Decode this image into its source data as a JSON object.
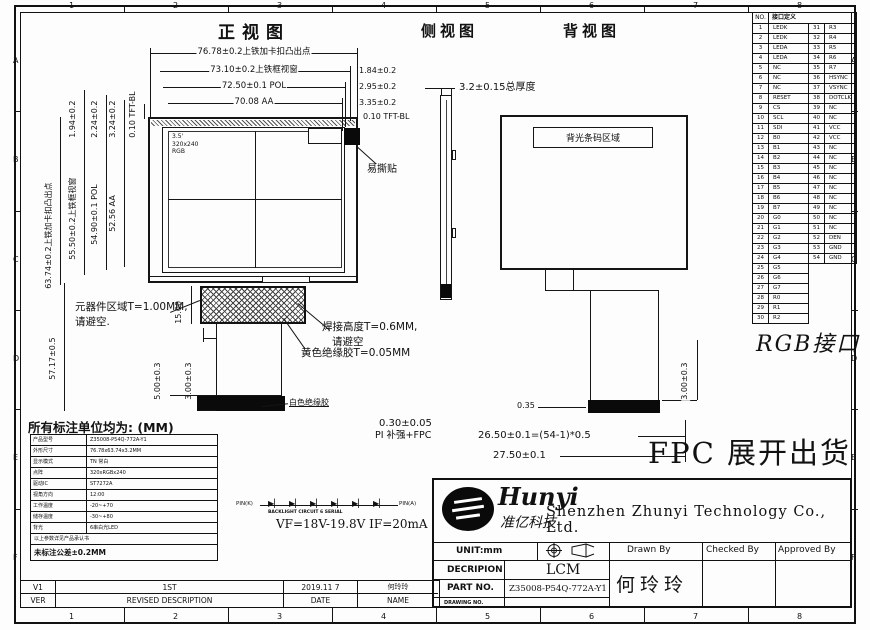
{
  "drawing": {
    "views": {
      "front_title": "正视图",
      "side_title": "侧视图",
      "back_title": "背视图"
    },
    "screen_marking": {
      "line1": "3.5'",
      "line2": "320x240",
      "line3": "RGB"
    },
    "labels": {
      "tear_sticker": "易撕贴",
      "thickness": "3.2±0.15总厚度",
      "barcode_area": "背光条码区域",
      "component_area_1": "元器件区域T=1.00MM,",
      "component_area_2": "请避空.",
      "solder_1": "焊接高度T=0.6MM,",
      "solder_2": "请避空",
      "yellow_glue": "黄色绝缘胶T=0.05MM",
      "white_glue": "白色绝缘胶",
      "pi_thickness": "0.30±0.05",
      "pi_stiffener": "PI 补强+FPC",
      "fpc_ship": "FPC 展开出货",
      "rgb_interface": "RGB接口"
    },
    "dims": {
      "top": [
        "76.78±0.2上铁加卡扣凸出点",
        "73.10±0.2上铁框视窗",
        "72.50±0.1 POL",
        "70.08 AA"
      ],
      "top_right": [
        "1.84±0.2",
        "2.95±0.2",
        "3.35±0.2",
        "0.10 TFT-BL"
      ],
      "left_small": [
        "1.94±0.2",
        "2.24±0.2",
        "3.24±0.2",
        "0.10 TFT-BL"
      ],
      "left_main": [
        "63.74±0.2上铁加卡扣凸出点",
        "55.50±0.2上铁框视窗",
        "54.90±0.1 POL",
        "52.56 AA"
      ],
      "fpc_height": "15.00",
      "fpc_width": "40.00",
      "total_left": "57.17±0.5",
      "tail_5": "5.00±0.3",
      "tail_3": "3.00±0.3",
      "back_035": "0.35",
      "back_2650": "26.50±0.1=(54-1)*0.5",
      "back_2750": "27.50±0.1",
      "back_300": "3.00±0.3"
    },
    "backlight_circuit": {
      "left_pin": "PIN(K)",
      "right_pin": "PIN(A)",
      "caption": "BACKLIGHT CIRCUIT 6 SERIAL",
      "spec": "VF=18V-19.8V   IF=20mA"
    }
  },
  "pin_table": {
    "no_header": "NO.",
    "def_header": "接口定义",
    "rows": [
      [
        1,
        "LEDK",
        31,
        "R3"
      ],
      [
        2,
        "LEDK",
        32,
        "R4"
      ],
      [
        3,
        "LEDA",
        33,
        "R5"
      ],
      [
        4,
        "LEDA",
        34,
        "R6"
      ],
      [
        5,
        "NC",
        35,
        "R7"
      ],
      [
        6,
        "NC",
        36,
        "HSYNC"
      ],
      [
        7,
        "NC",
        37,
        "VSYNC"
      ],
      [
        8,
        "RESET",
        38,
        "DOTCLK"
      ],
      [
        9,
        "CS",
        39,
        "NC"
      ],
      [
        10,
        "SCL",
        40,
        "NC"
      ],
      [
        11,
        "SDI",
        41,
        "VCC"
      ],
      [
        12,
        "B0",
        42,
        "VCC"
      ],
      [
        13,
        "B1",
        43,
        "NC"
      ],
      [
        14,
        "B2",
        44,
        "NC"
      ],
      [
        15,
        "B3",
        45,
        "NC"
      ],
      [
        16,
        "B4",
        46,
        "NC"
      ],
      [
        17,
        "B5",
        47,
        "NC"
      ],
      [
        18,
        "B6",
        48,
        "NC"
      ],
      [
        19,
        "B7",
        49,
        "NC"
      ],
      [
        20,
        "G0",
        50,
        "NC"
      ],
      [
        21,
        "G1",
        51,
        "NC"
      ],
      [
        22,
        "G2",
        52,
        "DEN"
      ],
      [
        23,
        "G3",
        53,
        "GND"
      ],
      [
        24,
        "G4",
        54,
        "GND"
      ],
      [
        25,
        "G5",
        null,
        null
      ],
      [
        26,
        "G6",
        null,
        null
      ],
      [
        27,
        "G7",
        null,
        null
      ],
      [
        28,
        "R0",
        null,
        null
      ],
      [
        29,
        "R1",
        null,
        null
      ],
      [
        30,
        "R2",
        null,
        null
      ]
    ]
  },
  "units_table": {
    "title": "所有标注单位均为: (MM)",
    "rows": [
      {
        "l": "产品型号",
        "v": "Z35008-P54Q-772A-Y1"
      },
      {
        "l": "外形尺寸",
        "v": "76.78x63.74x3.2MM"
      },
      {
        "l": "显示模式",
        "v": "TN 常白"
      },
      {
        "l": "点阵",
        "v": "320xRGBx240"
      },
      {
        "l": "驱动IC",
        "v": "ST7272A"
      },
      {
        "l": "视角方向",
        "v": "12:00"
      },
      {
        "l": "工作温度",
        "v": "-20~+70"
      },
      {
        "l": "储存温度",
        "v": "-30~+80"
      },
      {
        "l": "背光",
        "v": "6串白光LED"
      },
      {
        "l": "",
        "v": "以上参数详见产品承认书"
      },
      {
        "l": "",
        "v": "未标注公差±0.2MM"
      }
    ]
  },
  "title_block": {
    "logo_en": "Hunyi",
    "logo_cn": "准亿科技",
    "company": "Shenzhen Zhunyi Technology Co., Ltd.",
    "unit": "UNIT:mm",
    "drawn": "Drawn By",
    "checked": "Checked By",
    "approved": "Approved By",
    "decription_label": "DECRIPION",
    "decription": "LCM",
    "part_label": "PART NO.",
    "part_no": "Z35008-P54Q-772A-Y1",
    "drawing_label": "DRAWING NO.",
    "signer": "何玲玲"
  },
  "revision": {
    "ver": "V1",
    "desc": "1ST",
    "date": "2019.11 7",
    "name": "何玲玲",
    "ver_h": "VER",
    "desc_h": "REVISED DESCRIPTION",
    "date_h": "DATE",
    "name_h": "NAME"
  },
  "border": {
    "cols": [
      "1",
      "2",
      "3",
      "4",
      "5",
      "6",
      "7",
      "8"
    ],
    "rows": [
      "A",
      "B",
      "C",
      "D",
      "E",
      "F"
    ]
  }
}
